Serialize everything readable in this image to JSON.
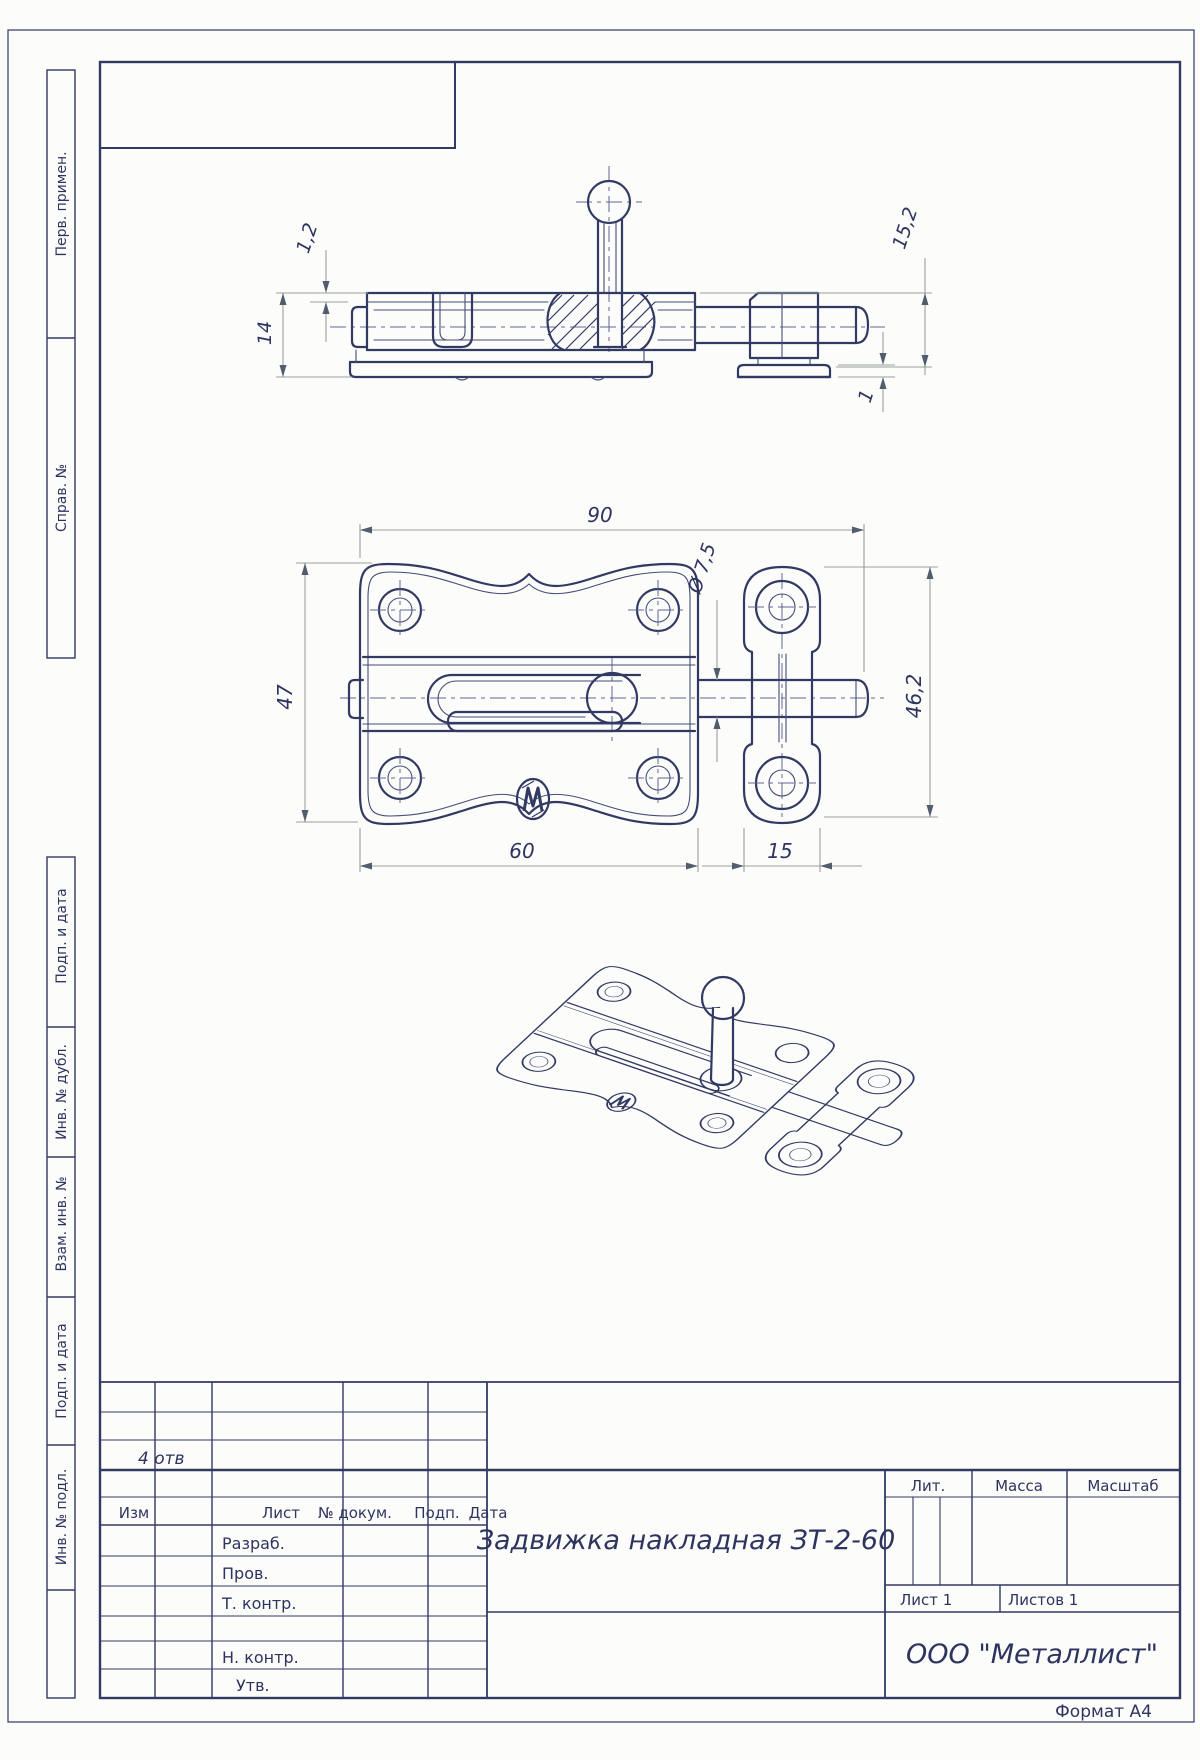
{
  "sheet": {
    "format_note": "Формат А4"
  },
  "margin_labels": [
    "Перв. примен.",
    "Справ. №",
    "Подп. и дата",
    "Инв. № дубл.",
    "Взам. инв. №",
    "Подп. и дата",
    "Инв. № подл."
  ],
  "title_block": {
    "rev_note": "4 отв",
    "header": {
      "izm": "Изм",
      "list": "Лист",
      "doc": "№ докум.",
      "podp": "Подп.",
      "data": "Дата"
    },
    "roles": {
      "razrab": "Разраб.",
      "prov": "Пров.",
      "tkontr": "Т. контр.",
      "nkontr": "Н. контр.",
      "utv": "Утв."
    },
    "doc_title": "Задвижка накладная ЗТ-2-60",
    "company": "ООО \"Металлист\"",
    "lit": "Лит.",
    "mass": "Масса",
    "scale": "Масштаб",
    "sheet_no": "Лист 1",
    "sheets_total": "Листов 1"
  },
  "dimensions": {
    "width_total": "90",
    "plate_width": "60",
    "keeper_width": "15",
    "plate_height": "47",
    "keeper_height": "46,2",
    "bolt_dia": "Ø 7,5",
    "body_height": "14",
    "cover_gap": "1,2",
    "keeper_total_h": "15,2",
    "flange_t": "1"
  }
}
